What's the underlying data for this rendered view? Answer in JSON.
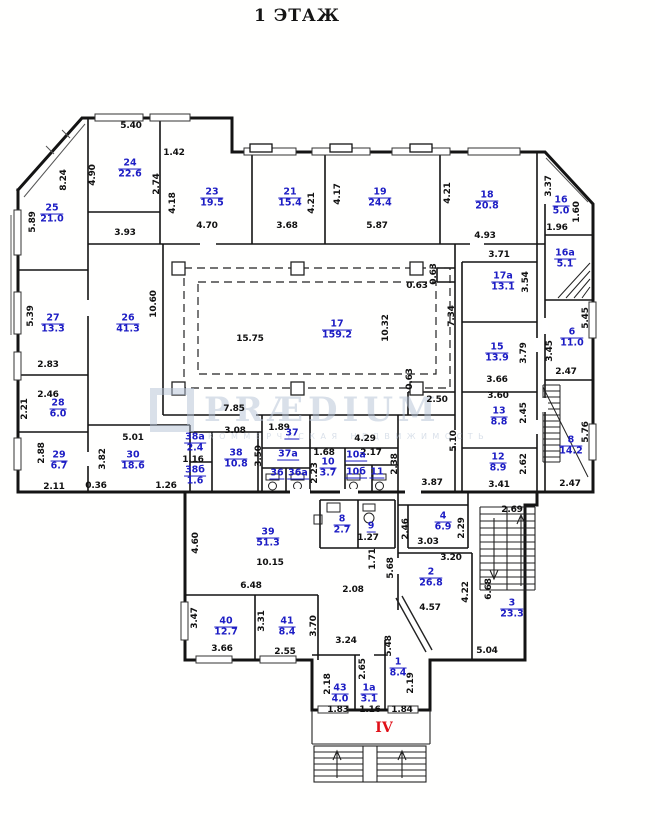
{
  "title": "1 ЭТАЖ",
  "entrance_label": "IV",
  "watermark": {
    "brand": "PRÆDIUM",
    "subtitle": "КОММЕРЧЕСКАЯ НЕДВИЖИМОСТЬ"
  },
  "colors": {
    "room": "#1d1dc4",
    "dim": "#111111",
    "entrance": "#e01018",
    "watermark": "#b4c2d6"
  },
  "rooms": [
    {
      "number": "25",
      "area": "21.0",
      "x": 52,
      "y": 214
    },
    {
      "number": "24",
      "area": "22.6",
      "x": 130,
      "y": 169
    },
    {
      "number": "23",
      "area": "19.5",
      "x": 212,
      "y": 198
    },
    {
      "number": "21",
      "area": "15.4",
      "x": 290,
      "y": 198
    },
    {
      "number": "19",
      "area": "24.4",
      "x": 380,
      "y": 198
    },
    {
      "number": "18",
      "area": "20.8",
      "x": 487,
      "y": 201
    },
    {
      "number": "16",
      "area": "5.0",
      "x": 561,
      "y": 206
    },
    {
      "number": "16а",
      "area": "5.1",
      "x": 565,
      "y": 259
    },
    {
      "number": "17а",
      "area": "13.1",
      "x": 503,
      "y": 282
    },
    {
      "number": "27",
      "area": "13.3",
      "x": 53,
      "y": 324
    },
    {
      "number": "26",
      "area": "41.3",
      "x": 128,
      "y": 324
    },
    {
      "number": "17",
      "area": "159.2",
      "x": 337,
      "y": 330
    },
    {
      "number": "15",
      "area": "13.9",
      "x": 497,
      "y": 353
    },
    {
      "number": "6",
      "area": "11.0",
      "x": 572,
      "y": 338
    },
    {
      "number": "28",
      "area": "6.0",
      "x": 58,
      "y": 409
    },
    {
      "number": "13",
      "area": "8.8",
      "x": 499,
      "y": 417
    },
    {
      "number": "29",
      "area": "6.7",
      "x": 59,
      "y": 461
    },
    {
      "number": "30",
      "area": "18.6",
      "x": 133,
      "y": 461
    },
    {
      "number": "38а",
      "area": "2.4",
      "x": 195,
      "y": 443
    },
    {
      "number": "38б",
      "area": "1.6",
      "x": 195,
      "y": 476
    },
    {
      "number": "38",
      "area": "10.8",
      "x": 236,
      "y": 459
    },
    {
      "number": "37",
      "area": null,
      "x": 292,
      "y": 434
    },
    {
      "number": "37а",
      "area": null,
      "x": 288,
      "y": 455
    },
    {
      "number": "36",
      "area": null,
      "x": 277,
      "y": 474
    },
    {
      "number": "36а",
      "area": null,
      "x": 298,
      "y": 474
    },
    {
      "number": "10",
      "area": "3.7",
      "x": 328,
      "y": 468
    },
    {
      "number": "10а",
      "area": null,
      "x": 356,
      "y": 456
    },
    {
      "number": "10б",
      "area": null,
      "x": 356,
      "y": 473
    },
    {
      "number": "11",
      "area": null,
      "x": 377,
      "y": 473
    },
    {
      "number": "12",
      "area": "8.9",
      "x": 498,
      "y": 463
    },
    {
      "number": "8",
      "area": "14.2",
      "x": 571,
      "y": 446
    },
    {
      "number": "39",
      "area": "51.3",
      "x": 268,
      "y": 538
    },
    {
      "number": "8",
      "area": "2.7",
      "x": 342,
      "y": 525
    },
    {
      "number": "9",
      "area": null,
      "x": 371,
      "y": 527
    },
    {
      "number": "4",
      "area": "6.9",
      "x": 443,
      "y": 522
    },
    {
      "number": "2",
      "area": "26.8",
      "x": 431,
      "y": 578
    },
    {
      "number": "3",
      "area": "23.3",
      "x": 512,
      "y": 609
    },
    {
      "number": "40",
      "area": "12.7",
      "x": 226,
      "y": 627
    },
    {
      "number": "41",
      "area": "8.4",
      "x": 287,
      "y": 627
    },
    {
      "number": "43",
      "area": "4.0",
      "x": 340,
      "y": 694
    },
    {
      "number": "1а",
      "area": "3.1",
      "x": 369,
      "y": 694
    },
    {
      "number": "1",
      "area": "8.4",
      "x": 398,
      "y": 668
    }
  ],
  "dims": [
    {
      "text": "5.40",
      "x": 131,
      "y": 126
    },
    {
      "text": "1.42",
      "x": 174,
      "y": 153
    },
    {
      "text": "8.24",
      "x": 64,
      "y": 180,
      "v": true
    },
    {
      "text": "4.90",
      "x": 93,
      "y": 175,
      "v": true
    },
    {
      "text": "2.74",
      "x": 157,
      "y": 184,
      "v": true
    },
    {
      "text": "5.89",
      "x": 33,
      "y": 222,
      "v": true
    },
    {
      "text": "4.18",
      "x": 173,
      "y": 203,
      "v": true
    },
    {
      "text": "4.70",
      "x": 207,
      "y": 226
    },
    {
      "text": "3.68",
      "x": 287,
      "y": 226
    },
    {
      "text": "4.21",
      "x": 312,
      "y": 203,
      "v": true
    },
    {
      "text": "4.17",
      "x": 338,
      "y": 194,
      "v": true
    },
    {
      "text": "5.87",
      "x": 377,
      "y": 226
    },
    {
      "text": "4.21",
      "x": 448,
      "y": 193,
      "v": true
    },
    {
      "text": "4.93",
      "x": 485,
      "y": 236
    },
    {
      "text": "3.37",
      "x": 549,
      "y": 186,
      "v": true
    },
    {
      "text": "1.60",
      "x": 577,
      "y": 212,
      "v": true
    },
    {
      "text": "1.96",
      "x": 557,
      "y": 228
    },
    {
      "text": "3.93",
      "x": 125,
      "y": 233
    },
    {
      "text": "10.60",
      "x": 154,
      "y": 304,
      "v": true
    },
    {
      "text": "5.39",
      "x": 31,
      "y": 316,
      "v": true
    },
    {
      "text": "2.83",
      "x": 48,
      "y": 365
    },
    {
      "text": "3.71",
      "x": 499,
      "y": 255
    },
    {
      "text": "3.54",
      "x": 526,
      "y": 282,
      "v": true
    },
    {
      "text": "0.63",
      "x": 417,
      "y": 286
    },
    {
      "text": "0.63",
      "x": 434,
      "y": 274,
      "v": true
    },
    {
      "text": "15.75",
      "x": 250,
      "y": 339
    },
    {
      "text": "10.32",
      "x": 386,
      "y": 328,
      "v": true
    },
    {
      "text": "7.34",
      "x": 452,
      "y": 316,
      "v": true
    },
    {
      "text": "3.45",
      "x": 550,
      "y": 351,
      "v": true
    },
    {
      "text": "5.45",
      "x": 586,
      "y": 318,
      "v": true
    },
    {
      "text": "3.79",
      "x": 524,
      "y": 353,
      "v": true
    },
    {
      "text": "3.66",
      "x": 497,
      "y": 380
    },
    {
      "text": "2.47",
      "x": 566,
      "y": 372
    },
    {
      "text": "2.46",
      "x": 48,
      "y": 395
    },
    {
      "text": "2.21",
      "x": 25,
      "y": 409,
      "v": true
    },
    {
      "text": "2.88",
      "x": 42,
      "y": 453,
      "v": true
    },
    {
      "text": "2.11",
      "x": 54,
      "y": 487
    },
    {
      "text": "3.82",
      "x": 103,
      "y": 459,
      "v": true
    },
    {
      "text": "5.01",
      "x": 133,
      "y": 438
    },
    {
      "text": "0.36",
      "x": 96,
      "y": 486
    },
    {
      "text": "1.26",
      "x": 166,
      "y": 486
    },
    {
      "text": "1.16",
      "x": 193,
      "y": 460
    },
    {
      "text": "3.08",
      "x": 235,
      "y": 431
    },
    {
      "text": "3.50",
      "x": 259,
      "y": 456,
      "v": true
    },
    {
      "text": "1.89",
      "x": 279,
      "y": 428
    },
    {
      "text": "1.68",
      "x": 324,
      "y": 453
    },
    {
      "text": "2.23",
      "x": 315,
      "y": 473,
      "v": true
    },
    {
      "text": "4.29",
      "x": 365,
      "y": 439
    },
    {
      "text": "2.17",
      "x": 371,
      "y": 453
    },
    {
      "text": "2.38",
      "x": 395,
      "y": 464,
      "v": true
    },
    {
      "text": "2.50",
      "x": 437,
      "y": 400
    },
    {
      "text": "0.63",
      "x": 410,
      "y": 379,
      "v": true
    },
    {
      "text": "7.85",
      "x": 234,
      "y": 409
    },
    {
      "text": "3.60",
      "x": 498,
      "y": 396
    },
    {
      "text": "2.45",
      "x": 524,
      "y": 413,
      "v": true
    },
    {
      "text": "5.10",
      "x": 454,
      "y": 441,
      "v": true
    },
    {
      "text": "3.41",
      "x": 499,
      "y": 485
    },
    {
      "text": "2.62",
      "x": 524,
      "y": 464,
      "v": true
    },
    {
      "text": "5.76",
      "x": 586,
      "y": 432,
      "v": true
    },
    {
      "text": "2.47",
      "x": 570,
      "y": 484
    },
    {
      "text": "3.87",
      "x": 432,
      "y": 483
    },
    {
      "text": "4.60",
      "x": 196,
      "y": 543,
      "v": true
    },
    {
      "text": "10.15",
      "x": 270,
      "y": 563
    },
    {
      "text": "6.48",
      "x": 251,
      "y": 586
    },
    {
      "text": "1.27",
      "x": 368,
      "y": 538
    },
    {
      "text": "1.71",
      "x": 373,
      "y": 559,
      "v": true
    },
    {
      "text": "5.68",
      "x": 391,
      "y": 568,
      "v": true
    },
    {
      "text": "2.08",
      "x": 353,
      "y": 590
    },
    {
      "text": "2.46",
      "x": 406,
      "y": 529,
      "v": true
    },
    {
      "text": "2.29",
      "x": 462,
      "y": 528,
      "v": true
    },
    {
      "text": "3.03",
      "x": 428,
      "y": 542
    },
    {
      "text": "3.20",
      "x": 451,
      "y": 558
    },
    {
      "text": "2.69",
      "x": 512,
      "y": 510
    },
    {
      "text": "4.57",
      "x": 430,
      "y": 608
    },
    {
      "text": "4.22",
      "x": 466,
      "y": 592,
      "v": true
    },
    {
      "text": "6.68",
      "x": 489,
      "y": 589,
      "v": true
    },
    {
      "text": "3.47",
      "x": 195,
      "y": 618,
      "v": true
    },
    {
      "text": "3.66",
      "x": 222,
      "y": 649
    },
    {
      "text": "3.31",
      "x": 262,
      "y": 621,
      "v": true
    },
    {
      "text": "2.55",
      "x": 285,
      "y": 652
    },
    {
      "text": "3.70",
      "x": 314,
      "y": 626,
      "v": true
    },
    {
      "text": "3.24",
      "x": 346,
      "y": 641
    },
    {
      "text": "5.48",
      "x": 389,
      "y": 646,
      "v": true
    },
    {
      "text": "5.04",
      "x": 487,
      "y": 651
    },
    {
      "text": "2.18",
      "x": 328,
      "y": 684,
      "v": true
    },
    {
      "text": "2.65",
      "x": 363,
      "y": 669,
      "v": true
    },
    {
      "text": "2.19",
      "x": 411,
      "y": 683,
      "v": true
    },
    {
      "text": "1.83",
      "x": 338,
      "y": 710
    },
    {
      "text": "1.16",
      "x": 370,
      "y": 710
    },
    {
      "text": "1.84",
      "x": 402,
      "y": 710
    }
  ]
}
